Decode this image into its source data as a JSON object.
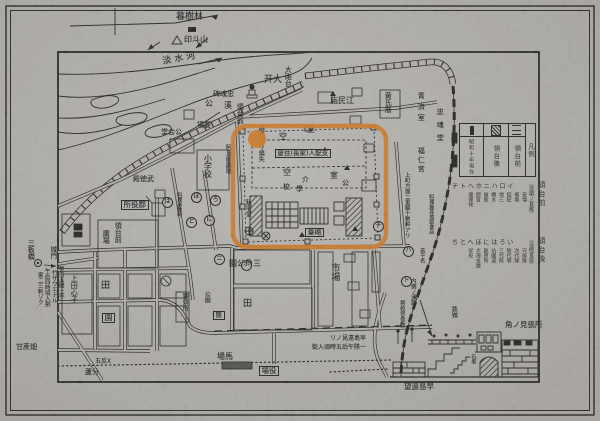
{
  "colors": {
    "paper": "#cac7c1",
    "ink": "#1a191c",
    "highlight_orange": "#ec8420"
  },
  "highlight": {
    "shape": "rounded-rect-and-dot"
  },
  "legend": {
    "columns": [
      {
        "label": "昭和十年現在",
        "symbol": "solid"
      },
      {
        "label": "領台後",
        "symbol": "hatch"
      },
      {
        "label": "領台前",
        "symbol": "lines"
      },
      {
        "label": "凡例",
        "symbol": null
      }
    ]
  },
  "notes": [
    {
      "header": "チトヘホニハロイ",
      "bracket": "（清朝ノ官廨）",
      "side": "領台前",
      "items": [
        "安増",
        "複堆",
        "錠紀",
        "地三",
        "棚木",
        "屋堅",
        "厨官",
        "遵理快"
      ]
    },
    {
      "header": "ちとへほにはろい",
      "bracket": "（当時官廈）",
      "side": "領台後",
      "items": [
        "守候隊",
        "次代隊",
        "智代等",
        "三代既",
        "坑園速",
        "畝房所",
        "大海支廳",
        "学校"
      ]
    }
  ],
  "map": {
    "labels": [
      {
        "t": "暮樹林",
        "x": 176,
        "y": 13,
        "s": 9
      },
      {
        "t": "印斗山",
        "x": 184,
        "y": 36,
        "s": 8
      },
      {
        "t": "淡水河",
        "x": 162,
        "y": 58,
        "s": 9,
        "rot": -10,
        "ls": 3
      },
      {
        "t": "公",
        "x": 205,
        "y": 100,
        "s": 8
      },
      {
        "t": "溪",
        "x": 224,
        "y": 102,
        "s": 8
      },
      {
        "t": "碑魂忠",
        "x": 213,
        "y": 91,
        "s": 7
      },
      {
        "t": "領台前",
        "x": 236,
        "y": 103,
        "v": 1,
        "s": 7
      },
      {
        "t": "場要",
        "x": 197,
        "y": 122,
        "s": 7
      },
      {
        "t": "开大",
        "x": 264,
        "y": 76,
        "s": 9
      },
      {
        "t": "大砲台",
        "x": 284,
        "y": 66,
        "v": 1,
        "s": 7
      },
      {
        "t": "堂会公",
        "x": 161,
        "y": 129,
        "s": 7
      },
      {
        "t": "小学校",
        "x": 203,
        "y": 154,
        "v": 1,
        "s": 8
      },
      {
        "t": "阿旦前廣場",
        "x": 224,
        "y": 144,
        "v": 1,
        "s": 6
      },
      {
        "t": "殿徳武",
        "x": 133,
        "y": 176,
        "s": 7
      },
      {
        "t": "所役郡",
        "x": 121,
        "y": 200,
        "s": 7.5,
        "boxed": 1
      },
      {
        "t": "料理屋數軒",
        "x": 176,
        "y": 192,
        "v": 1,
        "s": 5
      },
      {
        "t": "領台前",
        "x": 114,
        "y": 222,
        "v": 1,
        "s": 7
      },
      {
        "t": "廣場",
        "x": 102,
        "y": 230,
        "v": 1,
        "s": 7
      },
      {
        "t": "上田心子",
        "x": 70,
        "y": 275,
        "v": 1,
        "s": 7
      },
      {
        "t": "田",
        "x": 101,
        "y": 282,
        "s": 9
      },
      {
        "t": "園",
        "x": 102,
        "y": 313,
        "s": 8,
        "boxed": 1
      },
      {
        "t": "田",
        "x": 243,
        "y": 300,
        "s": 9
      },
      {
        "t": "警察所",
        "x": 181,
        "y": 293,
        "v": 1,
        "s": 6
      },
      {
        "t": "公園",
        "x": 203,
        "y": 291,
        "v": 1,
        "s": 6
      },
      {
        "t": "匯",
        "x": 213,
        "y": 311,
        "s": 6.5,
        "boxed": 1
      },
      {
        "t": "園公角三",
        "x": 229,
        "y": 260,
        "s": 8
      },
      {
        "t": "市場",
        "x": 329,
        "y": 263,
        "v": 1,
        "s": 9
      },
      {
        "t": "場馬",
        "x": 217,
        "y": 353,
        "s": 8
      },
      {
        "t": "場役",
        "x": 259,
        "y": 366,
        "s": 7.5,
        "boxed": 1
      },
      {
        "t": "三板橋",
        "x": 27,
        "y": 239,
        "v": 1,
        "s": 7
      },
      {
        "t": "城門",
        "x": 49,
        "y": 246,
        "v": 1,
        "s": 6.5
      },
      {
        "t": "整市五間土手",
        "x": 57,
        "y": 266,
        "v": 1,
        "s": 5.5
      },
      {
        "t": "竹ザウエテル",
        "x": 50,
        "y": 270,
        "v": 1,
        "s": 5.5
      },
      {
        "t": "午后四時頃入割",
        "x": 43,
        "y": 268,
        "v": 1,
        "s": 5.5
      },
      {
        "t": "家二三軒ゾク",
        "x": 36,
        "y": 272,
        "v": 1,
        "s": 5.5
      },
      {
        "t": "甘蔗畑",
        "x": 16,
        "y": 344,
        "s": 7
      },
      {
        "t": "五反X",
        "x": 95,
        "y": 359,
        "s": 6
      },
      {
        "t": "蘆分",
        "x": 85,
        "y": 369,
        "s": 7
      },
      {
        "t": "リノ見遠島早",
        "x": 330,
        "y": 336,
        "s": 6
      },
      {
        "t": "街入頃時五后午隊一",
        "x": 312,
        "y": 345,
        "s": 6
      },
      {
        "t": "望遠島早",
        "x": 404,
        "y": 383,
        "s": 7.5
      },
      {
        "t": "角ノ見張所",
        "x": 505,
        "y": 321,
        "s": 7.5
      },
      {
        "t": "内側ノ通路",
        "x": 409,
        "y": 278,
        "v": 1,
        "s": 5.5
      },
      {
        "t": "将校官舎敷",
        "x": 398,
        "y": 300,
        "v": 1,
        "s": 5.5
      },
      {
        "t": "鉄嶺",
        "x": 450,
        "y": 306,
        "v": 1,
        "s": 6
      },
      {
        "t": "石垠",
        "x": 470,
        "y": 354,
        "v": 1,
        "s": 5
      },
      {
        "t": "庙民江",
        "x": 330,
        "y": 97,
        "s": 8
      },
      {
        "t": "黄氏厝",
        "x": 384,
        "y": 92,
        "v": 1,
        "s": 7
      },
      {
        "t": "青済室",
        "x": 417,
        "y": 92,
        "v": 1,
        "s": 7,
        "ls": 4
      },
      {
        "t": "忠魂堂",
        "x": 436,
        "y": 108,
        "v": 1,
        "s": 7,
        "ls": 6
      },
      {
        "t": "福仁宮",
        "x": 417,
        "y": 147,
        "v": 1,
        "s": 7,
        "ls": 2
      },
      {
        "t": "上町方面ニ軍解十數軒アリ",
        "x": 403,
        "y": 172,
        "v": 1,
        "s": 5.5
      },
      {
        "t": "料理屋其他飲食店",
        "x": 428,
        "y": 194,
        "v": 1,
        "s": 5
      },
      {
        "t": "若干名",
        "x": 419,
        "y": 248,
        "v": 1,
        "s": 5
      },
      {
        "t": "砲擊在リ燒失",
        "x": 257,
        "y": 126,
        "v": 1,
        "s": 6
      },
      {
        "t": "室",
        "x": 307,
        "y": 126,
        "s": 8
      },
      {
        "t": "空",
        "x": 279,
        "y": 133,
        "s": 8
      },
      {
        "t": "厦住(長家)人配支",
        "x": 275,
        "y": 149,
        "s": 6.5,
        "boxed": 1
      },
      {
        "t": "空",
        "x": 283,
        "y": 169,
        "s": 8
      },
      {
        "t": "室",
        "x": 330,
        "y": 172,
        "s": 8
      },
      {
        "t": "介",
        "x": 302,
        "y": 177,
        "s": 7
      },
      {
        "t": "校",
        "x": 283,
        "y": 184,
        "s": 7
      },
      {
        "t": "學",
        "x": 296,
        "y": 186,
        "s": 7
      },
      {
        "t": "公",
        "x": 342,
        "y": 180,
        "s": 7
      },
      {
        "t": "私宅室",
        "x": 244,
        "y": 199,
        "v": 1,
        "s": 6
      },
      {
        "t": "臺砲",
        "x": 305,
        "y": 228,
        "s": 7,
        "boxed": 1
      },
      {
        "t": "は",
        "x": 162,
        "y": 197,
        "c": 1
      },
      {
        "t": "ろ",
        "x": 210,
        "y": 195,
        "c": 1
      },
      {
        "t": "ほ",
        "x": 191,
        "y": 192,
        "c": 1
      },
      {
        "t": "と",
        "x": 186,
        "y": 217,
        "c": 1
      },
      {
        "t": "に",
        "x": 204,
        "y": 215,
        "c": 1
      },
      {
        "t": "ニ",
        "x": 214,
        "y": 254,
        "c": 1
      },
      {
        "t": "ホ",
        "x": 241,
        "y": 260,
        "c": 1
      },
      {
        "t": "チ",
        "x": 373,
        "y": 221,
        "c": 1
      },
      {
        "t": "ハ",
        "x": 403,
        "y": 246,
        "c": 1
      },
      {
        "t": "ト",
        "x": 401,
        "y": 276,
        "c": 1
      }
    ]
  }
}
